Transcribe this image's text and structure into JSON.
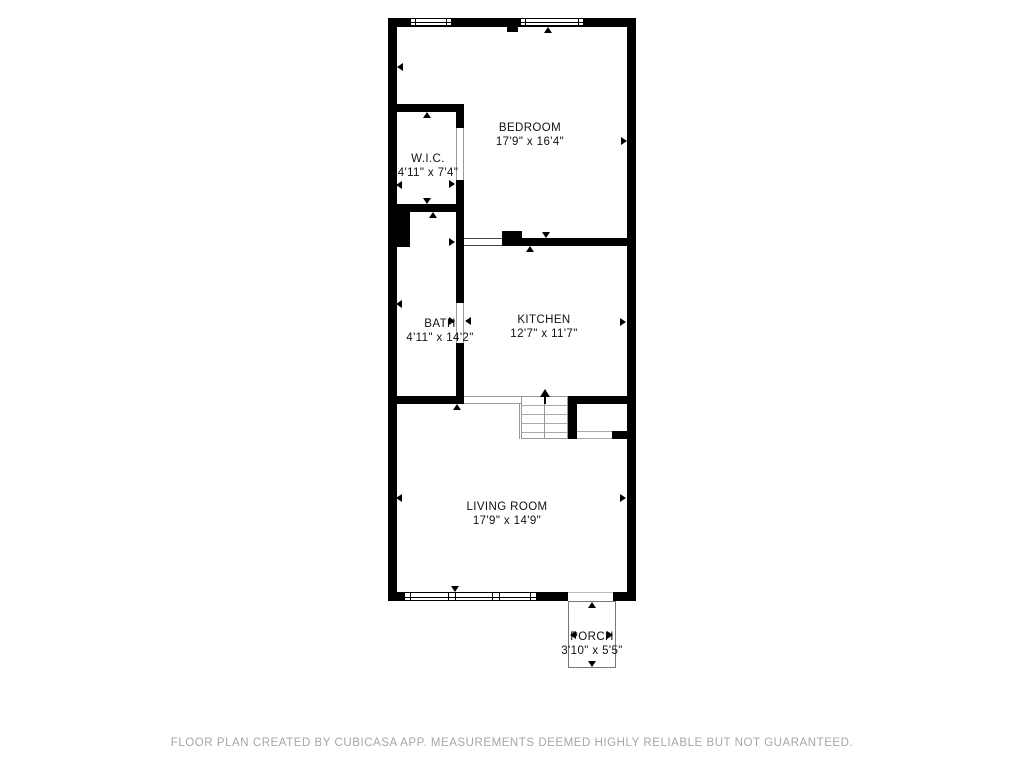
{
  "plan": {
    "creator_note": "FLOOR PLAN CREATED BY CUBICASA APP. MEASUREMENTS DEEMED HIGHLY RELIABLE BUT NOT GUARANTEED.",
    "rooms": {
      "bedroom": {
        "name": "BEDROOM",
        "dims": "17'9\" x 16'4\""
      },
      "wic": {
        "name": "W.I.C.",
        "dims": "4'11\" x 7'4\""
      },
      "bath": {
        "name": "BATH",
        "dims": "4'11\" x 14'2\""
      },
      "kitchen": {
        "name": "KITCHEN",
        "dims": "12'7\" x 11'7\""
      },
      "living_room": {
        "name": "LIVING ROOM",
        "dims": "17'9\" x 14'9\""
      },
      "porch": {
        "name": "PORCH",
        "dims": "3'10\" x 5'5\""
      }
    },
    "symbols": {
      "stair_arrow": "up-arrow",
      "wall_tick": "measurement-arrowhead"
    },
    "colors": {
      "wall": "#000000",
      "background": "#ffffff",
      "thin_line": "#999999",
      "footer_text": "#a6a6a6"
    }
  }
}
